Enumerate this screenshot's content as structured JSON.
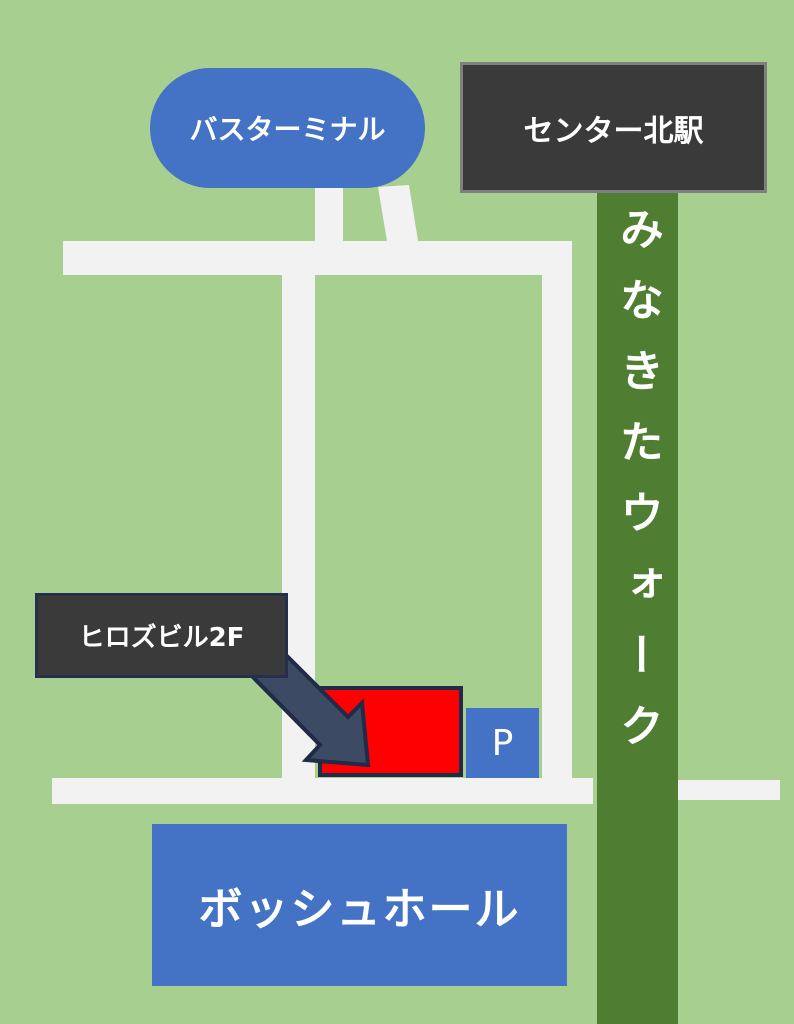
{
  "map": {
    "background_color": "#a7cf90",
    "road_color": "#f2f2f2",
    "bus_terminal": {
      "label": "バスターミナル",
      "color": "#4472c4",
      "text_color": "#ffffff"
    },
    "station": {
      "label": "センター北駅",
      "color": "#3a3a3a",
      "border_color": "#7f7f7f",
      "text_color": "#ffffff"
    },
    "walkway": {
      "label": "みなきたウォーク",
      "color": "#4f7d31",
      "text_color": "#ffffff"
    },
    "destination": {
      "sign_label": "ヒロズビル2F",
      "sign_color": "#3a3a3a",
      "building_color": "#fe0000",
      "outline_color": "#1f2b48",
      "arrow_fill": "#3d4a63"
    },
    "parking": {
      "label": "P",
      "color": "#4472c4",
      "text_color": "#ffffff"
    },
    "hall": {
      "label": "ボッシュホール",
      "color": "#4472c4",
      "text_color": "#ffffff"
    }
  }
}
